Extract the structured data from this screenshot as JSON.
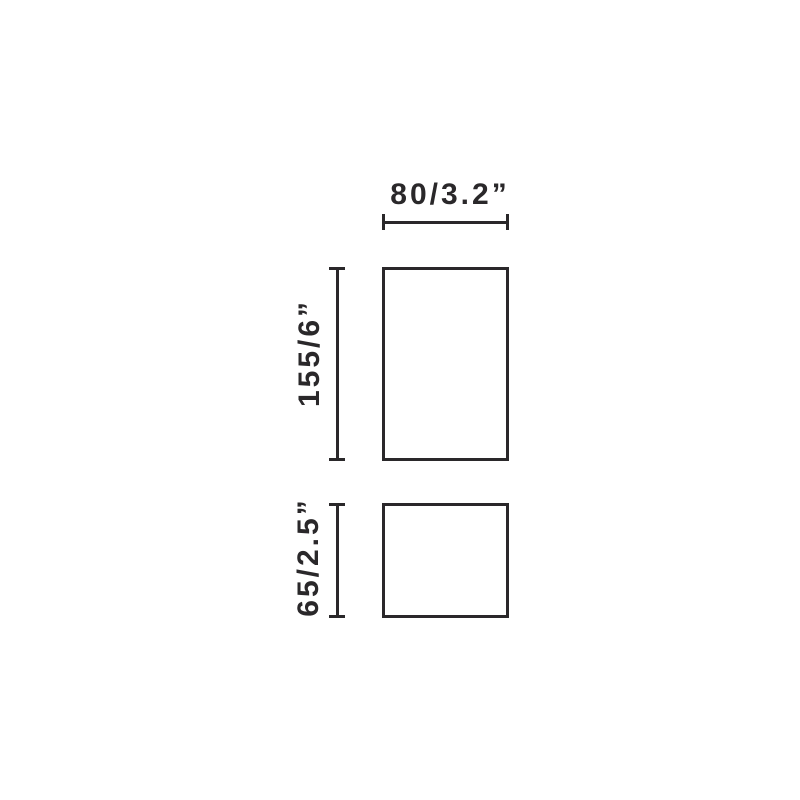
{
  "diagram": {
    "background_color": "#ffffff",
    "line_color": "#2a282a",
    "width_dimension": {
      "label": "80/3.2”"
    },
    "upper_height_dimension": {
      "label": "155/6”"
    },
    "lower_height_dimension": {
      "label": "65/2.5”"
    }
  }
}
